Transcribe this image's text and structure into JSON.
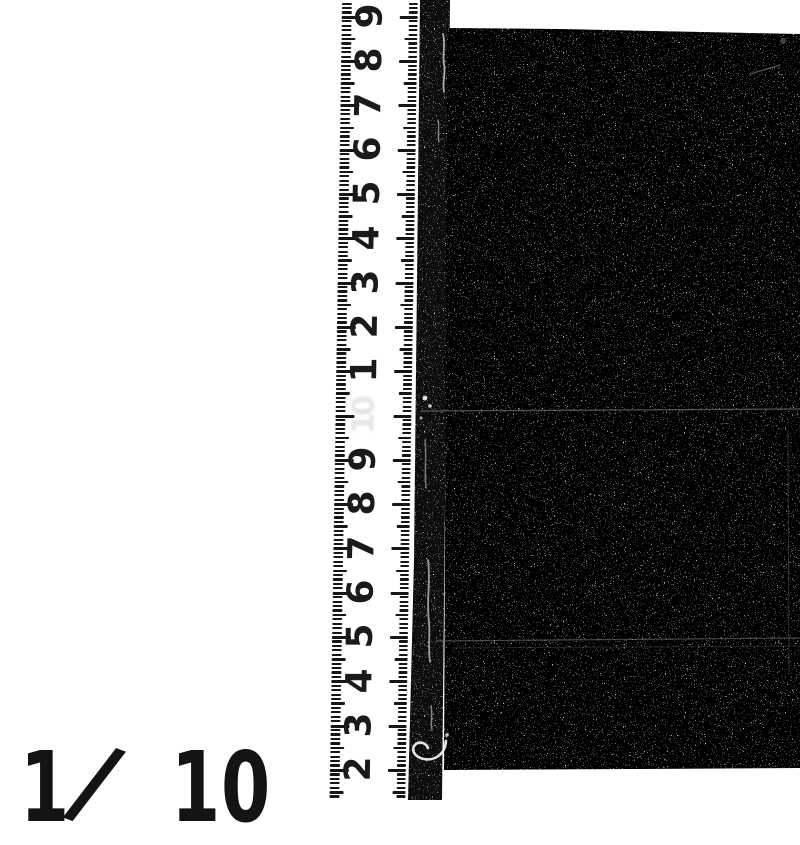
{
  "document_kind": "scanned photograph with measurement scale",
  "colors": {
    "page_bg": "#ffffff",
    "ink": "#161616",
    "film_black": "#060606",
    "film_edge_black": "#0a0a0a",
    "scratch_white": "#e6e6e6"
  },
  "ruler": {
    "numbers": [
      "9",
      "8",
      "7",
      "6",
      "5",
      "4",
      "3",
      "2",
      "1",
      "10",
      "9",
      "8",
      "7",
      "6",
      "5",
      "4",
      "3",
      "2"
    ],
    "ghost_index": 9,
    "first_major_y": 17,
    "unit_spacing_px": 44.3,
    "minor_per_unit": 10
  },
  "stamp": {
    "numerator": "1",
    "slash": "/",
    "denominator": "10"
  }
}
